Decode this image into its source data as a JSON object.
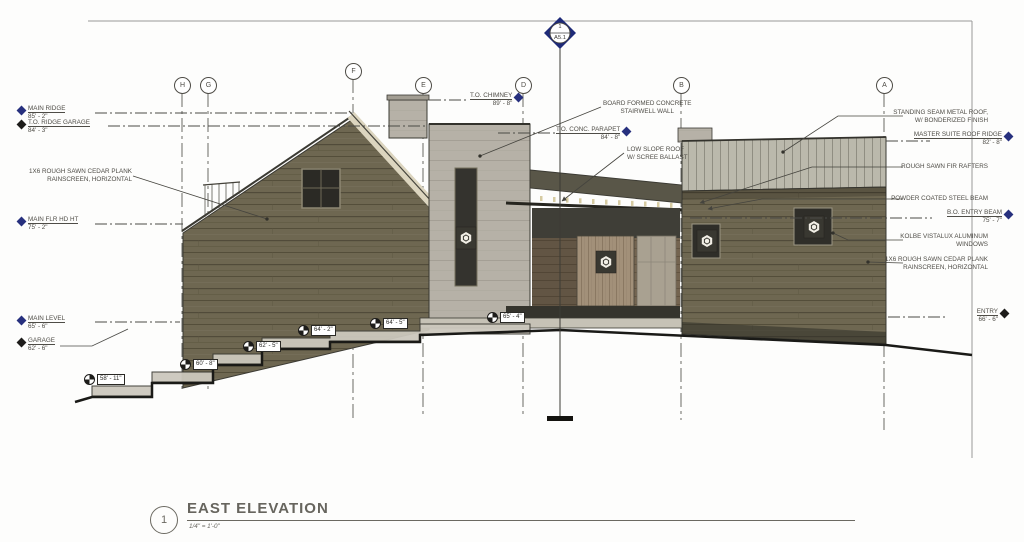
{
  "sheet": {
    "view_number": "1",
    "view_title": "EAST ELEVATION",
    "view_scale": "1/4\" = 1'-0\""
  },
  "section_marker": {
    "detail": "1",
    "sheet": "A5.1"
  },
  "grid": [
    "H",
    "G",
    "F",
    "E",
    "D",
    "B",
    "A"
  ],
  "datums": {
    "main_ridge": {
      "label": "MAIN RIDGE",
      "value": "85' - 2\""
    },
    "to_ridge_garage": {
      "label": "T.O. RIDGE GARAGE",
      "value": "84' - 3\""
    },
    "main_flr_hd_ht": {
      "label": "MAIN FLR HD HT",
      "value": "75' - 2\""
    },
    "main_level": {
      "label": "MAIN LEVEL",
      "value": "65' - 6\""
    },
    "garage": {
      "label": "GARAGE",
      "value": "62' - 6\""
    },
    "to_chimney": {
      "label": "T.O. CHIMNEY",
      "value": "89' - 8\""
    },
    "to_conc_parapet": {
      "label": "T.O. CONC. PARAPET",
      "value": "84' - 8\""
    },
    "master_suite_roof_ridge": {
      "label": "MASTER SUITE ROOF RIDGE",
      "value": "82' - 8\""
    },
    "bo_entry_beam": {
      "label": "B.O. ENTRY BEAM",
      "value": "75' - 7\""
    },
    "entry": {
      "label": "ENTRY",
      "value": "66' - 6\""
    }
  },
  "callouts": {
    "board_formed": {
      "line1": "BOARD FORMED CONCRETE",
      "line2": "STAIRWELL WALL"
    },
    "low_slope": {
      "line1": "LOW SLOPE ROOF",
      "line2": "W/ SCREE BALLAST"
    },
    "standing_seam": {
      "line1": "STANDING SEAM METAL ROOF,",
      "line2": "W/ BONDERIZED FINISH"
    },
    "fir_rafters": {
      "line1": "ROUGH SAWN FIR RAFTERS"
    },
    "steel_beam": {
      "line1": "POWDER COATED STEEL BEAM"
    },
    "kolbe_windows": {
      "line1": "KOLBE VISTALUX ALUMINUM",
      "line2": "WINDOWS"
    },
    "cedar_left": {
      "line1": "1X6 ROUGH SAWN CEDAR PLANK",
      "line2": "RAINSCREEN, HORIZONTAL"
    },
    "cedar_right": {
      "line1": "1X6 ROUGH SAWN CEDAR PLANK",
      "line2": "RAINSCREEN, HORIZONTAL"
    }
  },
  "spot_dims": [
    "58' - 11\"",
    "60' - 8\"",
    "62' - 5\"",
    "64' - 2\"",
    "64' - 5\"",
    "65' - 4\""
  ],
  "colors": {
    "wood_siding": "#6e6751",
    "concrete": "#b6b1a7",
    "metal_roof": "#bbb9ac",
    "fascia_cream": "#dcd5bf",
    "entry_door_wood": "#a29079",
    "datum_diamond_navy": "#27307e",
    "line_dark": "#3b3a33"
  }
}
